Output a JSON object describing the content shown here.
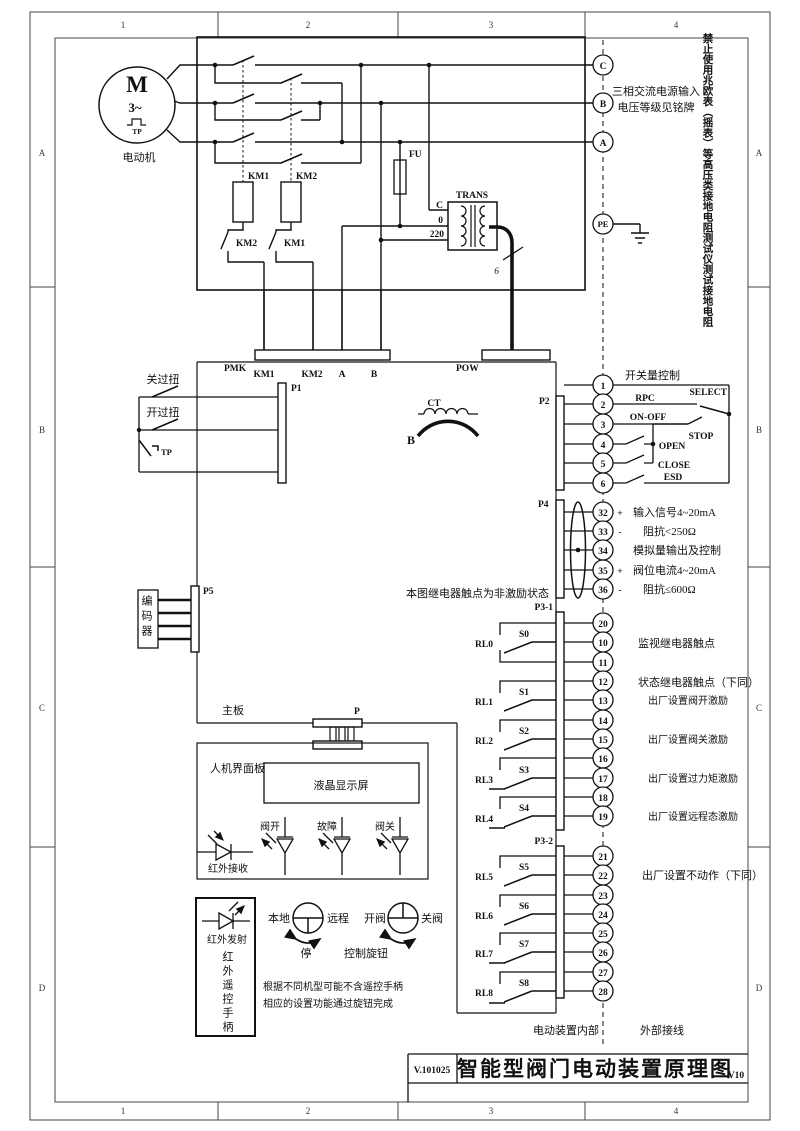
{
  "frame": {
    "cols": [
      "1",
      "2",
      "3",
      "4"
    ],
    "rows": [
      "A",
      "B",
      "C",
      "D"
    ]
  },
  "title_block": {
    "doc_no": "V.101025",
    "title": "智能型阀门电动装置原理图",
    "version": "V10"
  },
  "warning_vertical": "禁止使用兆欧表（摇表）等高压类接地电阻测试仪测试接地电阻",
  "motor": {
    "symbol": "M",
    "phases": "3~",
    "tp": "TP",
    "label": "电动机"
  },
  "power_box": {
    "km1_contact": "KM1",
    "km2_contact": "KM2",
    "km2_interlock": "KM2",
    "km1_interlock": "KM1",
    "fuse": "FU",
    "trans": "TRANS",
    "tap_c": "C",
    "tap_0": "0",
    "tap_220": "220",
    "core_count": "6"
  },
  "supply": {
    "c": "C",
    "b": "B",
    "a": "A",
    "pe": "PE",
    "note1": "三相交流电源输入",
    "note2": "电压等级见铭牌"
  },
  "bus": {
    "pmk": "PMK",
    "w_km1": "KM1",
    "w_km2": "KM2",
    "w_a": "A",
    "w_b": "B",
    "pow": "POW"
  },
  "p1": {
    "label": "P1",
    "close_torque": "关过扭",
    "open_torque": "开过扭",
    "tp": "TP"
  },
  "ct": {
    "label": "CT",
    "phase": "B"
  },
  "p2": {
    "label": "P2",
    "header": "开关量控制",
    "terminals": [
      "1",
      "2",
      "3",
      "4",
      "5",
      "6"
    ],
    "rpc": "RPC",
    "select": "SELECT",
    "onoff": "ON-OFF",
    "stop": "STOP",
    "open": "OPEN",
    "close": "CLOSE",
    "esd": "ESD"
  },
  "p4": {
    "label": "P4",
    "terminals": [
      "32",
      "33",
      "34",
      "35",
      "36"
    ],
    "s32": "+",
    "s33": "-",
    "s35": "+",
    "s36": "-",
    "input_signal": "输入信号4~20mA",
    "input_z": "阻抗<250Ω",
    "analog": "模拟量输出及控制",
    "valve_signal": "阀位电流4~20mA",
    "valve_z": "阻抗≤600Ω"
  },
  "p5": {
    "label": "P5",
    "encoder": "编码器"
  },
  "relay_note": "本图继电器触点为非激励状态",
  "p3_1": {
    "label": "P3-1",
    "terminals": [
      "20",
      "10",
      "11",
      "12",
      "13",
      "14",
      "15",
      "16",
      "17",
      "18",
      "19"
    ],
    "relays": [
      "RL0",
      "RL1",
      "RL2",
      "RL3",
      "RL4"
    ],
    "switches": [
      "S0",
      "S1",
      "S2",
      "S3",
      "S4"
    ],
    "note_monitor": "监视继电器触点",
    "note_status": "状态继电器触点（下同）",
    "note_open": "出厂设置阀开激励",
    "note_close": "出厂设置阀关激励",
    "note_torque": "出厂设置过力矩激励",
    "note_remote": "出厂设置远程态激励"
  },
  "p3_2": {
    "label": "P3-2",
    "terminals": [
      "21",
      "22",
      "23",
      "24",
      "25",
      "26",
      "27",
      "28"
    ],
    "relays": [
      "RL5",
      "RL6",
      "RL7",
      "RL8"
    ],
    "switches": [
      "S5",
      "S6",
      "S7",
      "S8"
    ],
    "note": "出厂设置不动作（下同）"
  },
  "board": {
    "main_label": "主板",
    "p_label": "P",
    "hmi_label": "人机界面板",
    "lcd": "液晶显示屏",
    "led_open": "阀开",
    "led_fault": "故障",
    "led_close": "阀关",
    "ir_rx": "红外接收"
  },
  "remote": {
    "ir_tx": "红外发射",
    "handle": "红外遥控手柄",
    "local": "本地",
    "remote": "远程",
    "stop": "停",
    "open": "开阀",
    "close": "关阀",
    "knob": "控制旋钮",
    "note1": "根据不同机型可能不含遥控手柄",
    "note2": "相应的设置功能通过旋钮完成"
  },
  "boundary": {
    "inside": "电动装置内部",
    "outside": "外部接线"
  }
}
